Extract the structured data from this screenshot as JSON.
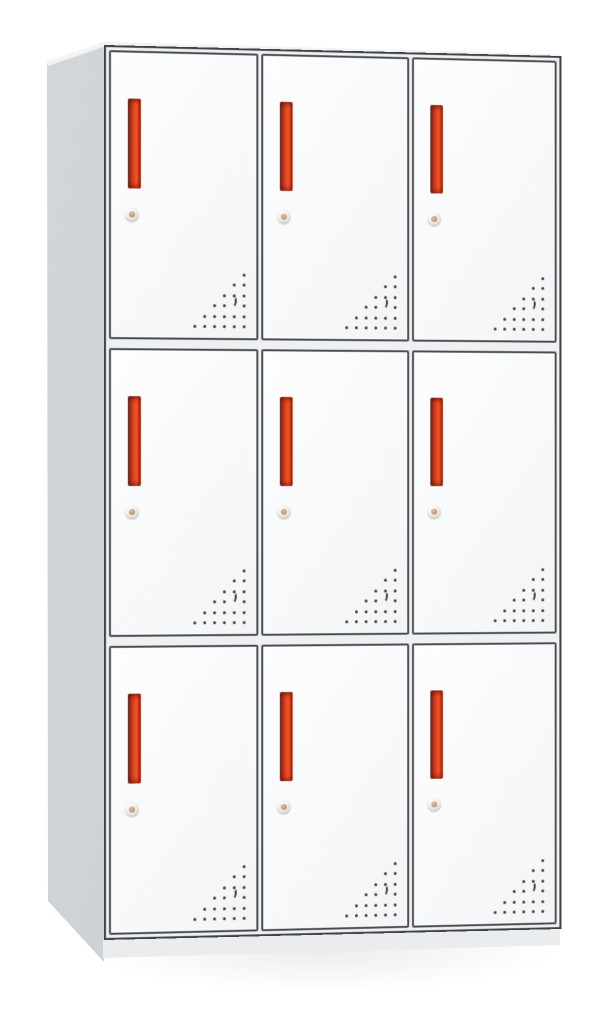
{
  "scene": {
    "type": "product-photo",
    "subject": "nine-door metal locker cabinet",
    "background_color": "#ffffff"
  },
  "cabinet": {
    "rows": 3,
    "cols": 3,
    "total_doors": 9,
    "doors": [
      {
        "id": "door-r1-c1",
        "row": 1,
        "col": 1
      },
      {
        "id": "door-r1-c2",
        "row": 1,
        "col": 2
      },
      {
        "id": "door-r1-c3",
        "row": 1,
        "col": 3
      },
      {
        "id": "door-r2-c1",
        "row": 2,
        "col": 1
      },
      {
        "id": "door-r2-c2",
        "row": 2,
        "col": 2
      },
      {
        "id": "door-r2-c3",
        "row": 2,
        "col": 3
      },
      {
        "id": "door-r3-c1",
        "row": 3,
        "col": 1
      },
      {
        "id": "door-r3-c2",
        "row": 3,
        "col": 2
      },
      {
        "id": "door-r3-c3",
        "row": 3,
        "col": 3
      }
    ],
    "door_features": {
      "handle": {
        "shape": "vertical-recessed-slot",
        "width_px": 13,
        "height_px": 90,
        "left_px": 17,
        "top_px": 46
      },
      "lock": {
        "shape": "round-cam-lock",
        "diameter_px": 14,
        "left_px": 14,
        "top_px": 155
      },
      "vent": {
        "pattern": "right-triangle-of-dots",
        "rows": 6,
        "dots_per_row": [
          1,
          2,
          3,
          4,
          5,
          6
        ],
        "alignment": "bottom-right",
        "h_spacing_px": 10,
        "v_spacing_px": 10.4,
        "dot_size_px": 3,
        "crescent": {
          "row": 4,
          "col_from_right": 2
        }
      }
    },
    "colors": {
      "background": "#ffffff",
      "frame_line": "#3f4347",
      "door_border": "#484c50",
      "door_face": "#f6f8f9",
      "gap_light": "#eef0f1",
      "side_panel_light": "#d3d7da",
      "side_panel_mid": "#cbd0d4",
      "side_panel_dark": "#c4c9cd",
      "top_sliver": "#f1f3f4",
      "base_plinth": "#e9ebec",
      "handle_bright": "#f4582b",
      "handle_mid": "#cc3a1d",
      "handle_darkest": "#7e2415",
      "lock_ring": "#ddd9d0",
      "lock_center": "#a57a52",
      "vent_dot": "#35393c"
    }
  }
}
